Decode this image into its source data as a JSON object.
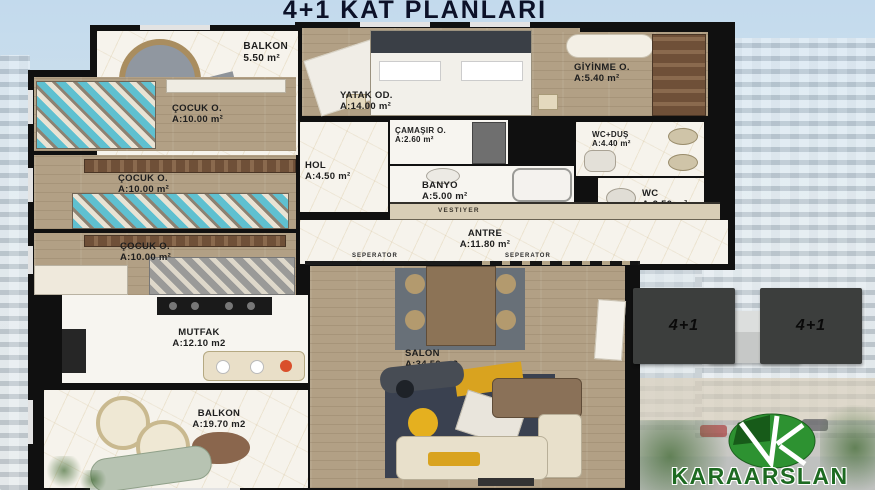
{
  "title": "4+1 KAT PLANLARI",
  "rooms": [
    {
      "name": "BALKON",
      "area": "5.50 m²"
    },
    {
      "name": "ÇOCUK O.",
      "area": "A:10.00 m²"
    },
    {
      "name": "ÇOCUK O.",
      "area": "A:10.00 m²"
    },
    {
      "name": "ÇOCUK O.",
      "area": "A:10.00 m²"
    },
    {
      "name": "YATAK OD.",
      "area": "A:14.00 m²"
    },
    {
      "name": "GİYİNME O.",
      "area": "A:5.40 m²"
    },
    {
      "name": "ÇAMAŞIR O.",
      "area": "A:2.60 m²"
    },
    {
      "name": "WC+DUŞ",
      "area": "A:4.40 m²"
    },
    {
      "name": "HOL",
      "area": "A:4.50 m²"
    },
    {
      "name": "BANYO",
      "area": "A:5.00 m²"
    },
    {
      "name": "WC",
      "area": "A:2.50 m²"
    },
    {
      "name": "ANTRE",
      "area": "A:11.80 m²"
    },
    {
      "name": "MUTFAK",
      "area": "A:12.10 m2"
    },
    {
      "name": "SALON",
      "area": "A:34.50 m2"
    },
    {
      "name": "BALKON",
      "area": "A:19.70 m2"
    }
  ],
  "labels": {
    "vestiyer": "VESTIYER",
    "seperator": "SEPERATOR"
  },
  "keyplan": {
    "left_label": "4+1",
    "right_label": "4+1"
  },
  "logo": {
    "text": "KARAARSLAN"
  },
  "colors": {
    "title": "#0c1128",
    "wall": "#101010",
    "wood_floor": "#b2a085",
    "marble_floor": "#f6f3ec",
    "sky": "#c3daed",
    "keyplan_block": "#3c3e3d",
    "logo_green": "#2d9231",
    "logo_text_green": "#1d6a21"
  }
}
